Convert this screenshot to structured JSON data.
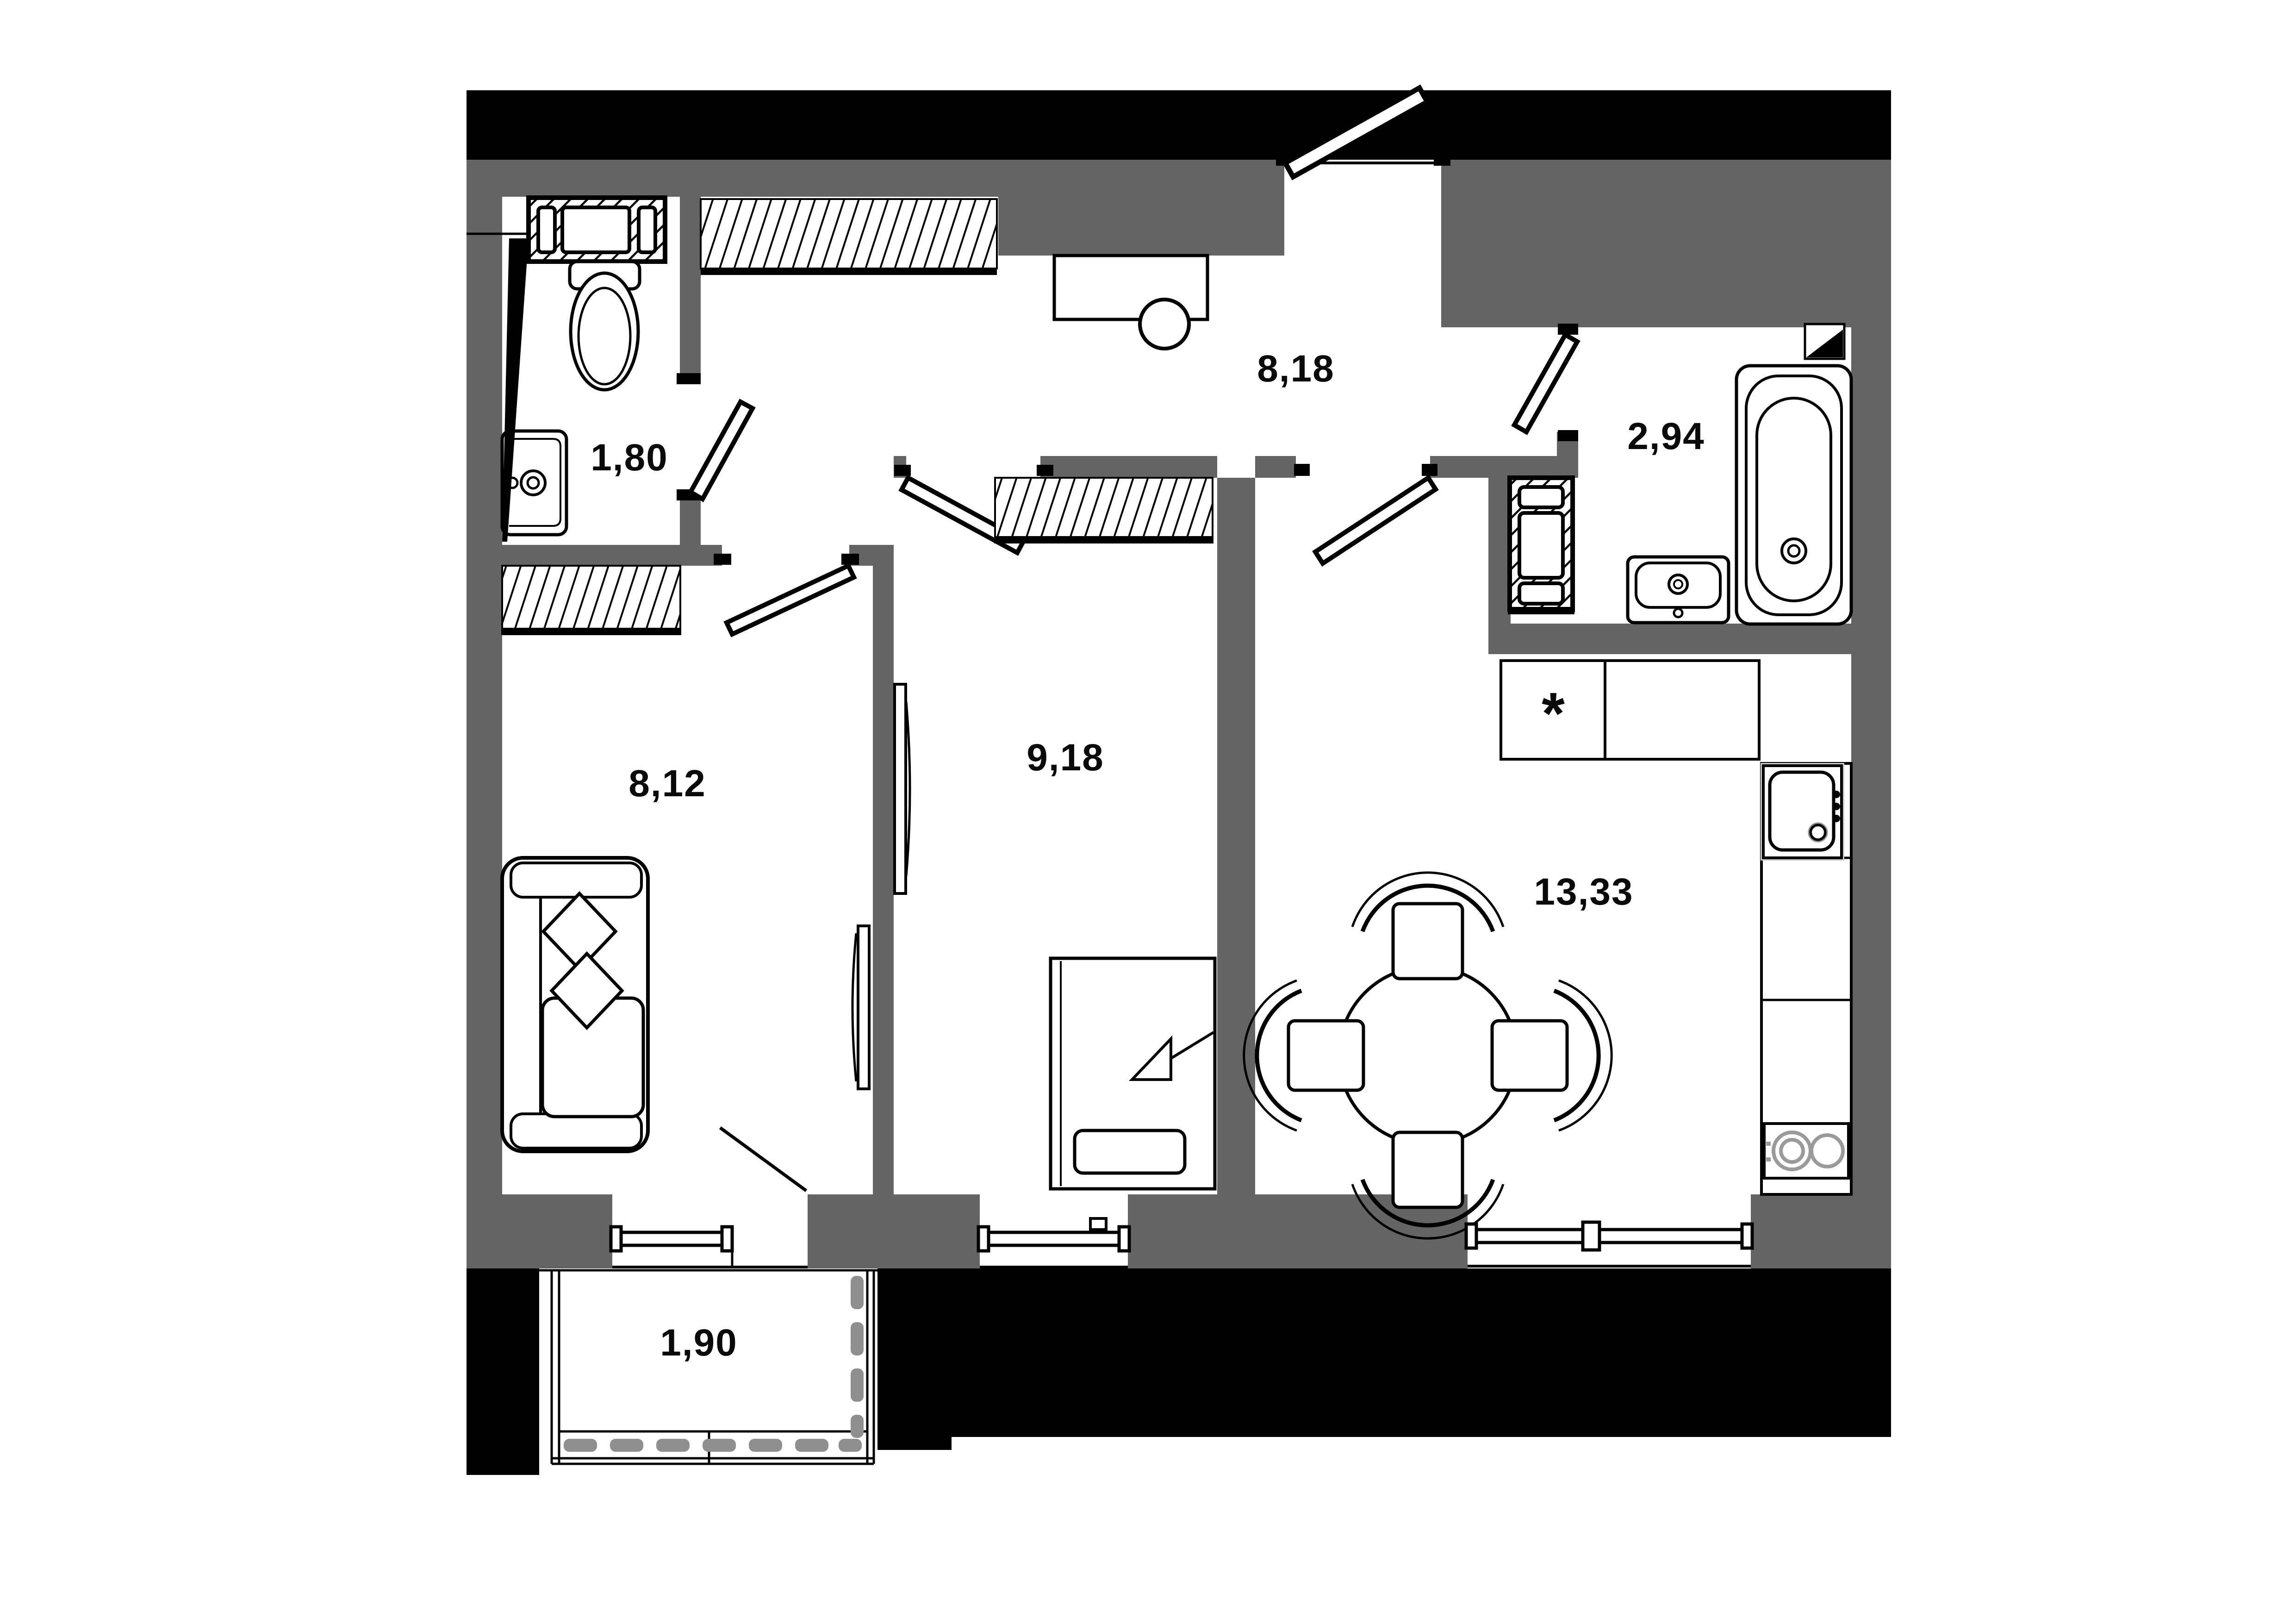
{
  "plan": {
    "type": "apartment-floor-plan",
    "rooms": [
      {
        "id": "wc",
        "area": "1,80"
      },
      {
        "id": "hallway",
        "area": "8,18"
      },
      {
        "id": "bathroom",
        "area": "2,94"
      },
      {
        "id": "living-room",
        "area": "8,12"
      },
      {
        "id": "bedroom",
        "area": "9,18"
      },
      {
        "id": "kitchen",
        "area": "13,33"
      },
      {
        "id": "balcony",
        "area": "1,90"
      }
    ],
    "markers": {
      "fridge_star": "*"
    },
    "colors": {
      "background": "#ffffff",
      "interior_wall": "#646464",
      "exterior_wall": "#000000",
      "line": "#000000",
      "railing_dash": "#8f8f8f",
      "burner_gray": "#9a9a9a"
    }
  }
}
